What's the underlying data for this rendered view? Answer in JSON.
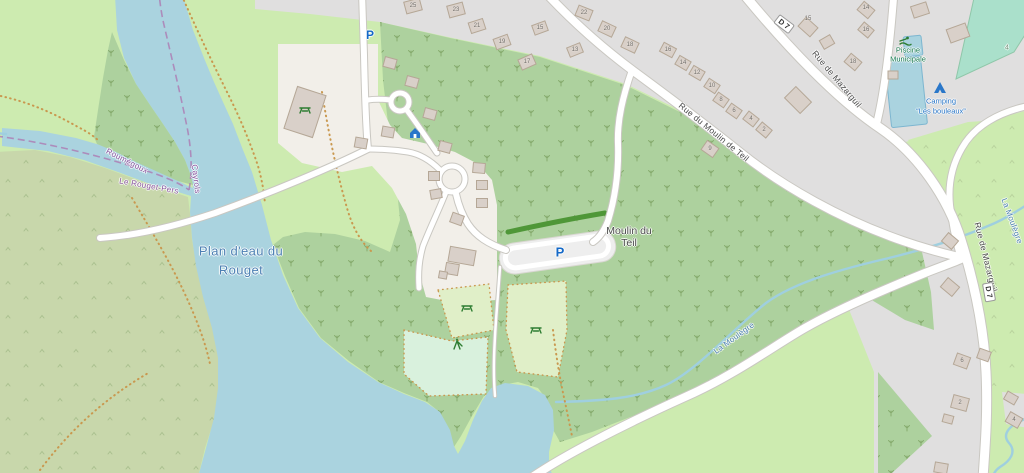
{
  "map": {
    "labels": {
      "water_name_line1": "Plan d'eau du",
      "water_name_line2": "Rouget",
      "place_line1": "Moulin du",
      "place_line2": "Teil",
      "street_moulin": "Rue du Moulin de Teil",
      "street_mazarguil": "Rue de Mazarguil",
      "road_ref": "D 7",
      "pool_line1": "Piscine",
      "pool_line2": "Municipale",
      "camping_line1": "Camping",
      "camping_line2": "“Les bouleaux”",
      "stream_name": "La Moulègre",
      "boundary_1": "Roumégoux",
      "boundary_2": "Le Rouget-Pers",
      "boundary_3": "Cayrols",
      "parking": "P",
      "pitch_ref": "4"
    },
    "house_numbers": [
      {
        "t": "25",
        "x": 413,
        "y": 6
      },
      {
        "t": "23",
        "x": 456,
        "y": 10
      },
      {
        "t": "21",
        "x": 477,
        "y": 26
      },
      {
        "t": "19",
        "x": 502,
        "y": 42
      },
      {
        "t": "17",
        "x": 527,
        "y": 62
      },
      {
        "t": "15",
        "x": 540,
        "y": 28
      },
      {
        "t": "13",
        "x": 575,
        "y": 50
      },
      {
        "t": "22",
        "x": 584,
        "y": 13
      },
      {
        "t": "20",
        "x": 607,
        "y": 29
      },
      {
        "t": "18",
        "x": 630,
        "y": 45
      },
      {
        "t": "16",
        "x": 668,
        "y": 50
      },
      {
        "t": "14",
        "x": 683,
        "y": 63
      },
      {
        "t": "12",
        "x": 697,
        "y": 73
      },
      {
        "t": "10",
        "x": 712,
        "y": 86
      },
      {
        "t": "8",
        "x": 721,
        "y": 100
      },
      {
        "t": "6",
        "x": 734,
        "y": 111
      },
      {
        "t": "4",
        "x": 751,
        "y": 119
      },
      {
        "t": "2",
        "x": 764,
        "y": 130
      },
      {
        "t": "9",
        "x": 710,
        "y": 149
      },
      {
        "t": "15",
        "x": 808,
        "y": 19
      },
      {
        "t": "14",
        "x": 866,
        "y": 8
      },
      {
        "t": "16",
        "x": 866,
        "y": 30
      },
      {
        "t": "18",
        "x": 853,
        "y": 62
      },
      {
        "t": "6",
        "x": 962,
        "y": 361
      },
      {
        "t": "2",
        "x": 960,
        "y": 403
      },
      {
        "t": "4",
        "x": 1014,
        "y": 420
      }
    ],
    "colors": {
      "water": "#aad3df",
      "wood": "#add19e",
      "grass": "#cdebb0",
      "scrub": "#c8d7ab",
      "residential": "#e0dfdf",
      "land": "#f2efe9",
      "building": "#d9d0c9",
      "buildingBorder": "#b5a796",
      "road": "#ffffff",
      "roadCasing": "#c9c7c1",
      "parkingFill": "#eeeeee",
      "parkingBlue": "#1569c7",
      "waterLabel": "#4d80b3",
      "streetLabel": "#4a4a4a",
      "placeLabel": "#4e4e4e",
      "houseNumber": "#6f6b66",
      "boundary": "#ad7fb5",
      "boundaryText": "#8a56a0",
      "leisureGreen": "#1d7d52",
      "tourismBlue": "#2a77c9",
      "hedge": "#4f9738",
      "pitch": "#aae0cb",
      "pitchBorder": "#8fc7a9",
      "plot": "#e0efc8",
      "playground": "#d9f1dd",
      "pathDots": "#c9984f",
      "stream": "#9fcfdf",
      "poolBorder": "#7db6d0"
    }
  }
}
